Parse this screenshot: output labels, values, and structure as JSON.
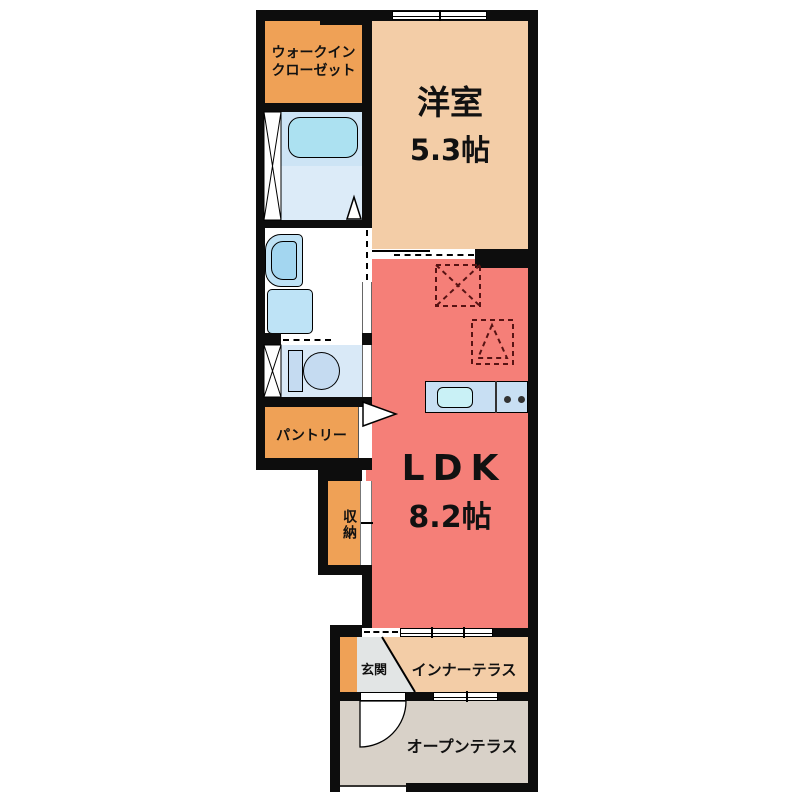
{
  "plan_type": "apartment-floorplan",
  "rooms": {
    "walk_in_closet": {
      "label_line1": "ウォークイン",
      "label_line2": "クローゼット"
    },
    "western_room": {
      "label": "洋室",
      "size": "5.3帖"
    },
    "ldk": {
      "label": "LDK",
      "size": "8.2帖"
    },
    "pantry": {
      "label": "パントリー"
    },
    "storage": {
      "label": "収納"
    },
    "entrance": {
      "label": "玄関"
    },
    "inner_terrace": {
      "label": "インナーテラス"
    },
    "open_terrace": {
      "label": "オープンテラス"
    }
  },
  "colors": {
    "wall": "#0d0d0d",
    "closet_orange": "#efa156",
    "room_beige": "#f3cda7",
    "ldk_red": "#f57f78",
    "bath_blue_upper": "#cde4f5",
    "bath_blue_lower": "#dcebf8",
    "bathtub_cyan": "#ace1f1",
    "toilet_room_blue": "#d9e9f7",
    "fixture_blue": "#c5dbf1",
    "appliance_blue": "#bee3f6",
    "counter_blue": "#c8dff3",
    "sink_cyan": "#c9f1f6",
    "entrance_gray": "#e2e5e5",
    "terrace_gray": "#d8d1c8",
    "dashed_marker": "#571313"
  }
}
